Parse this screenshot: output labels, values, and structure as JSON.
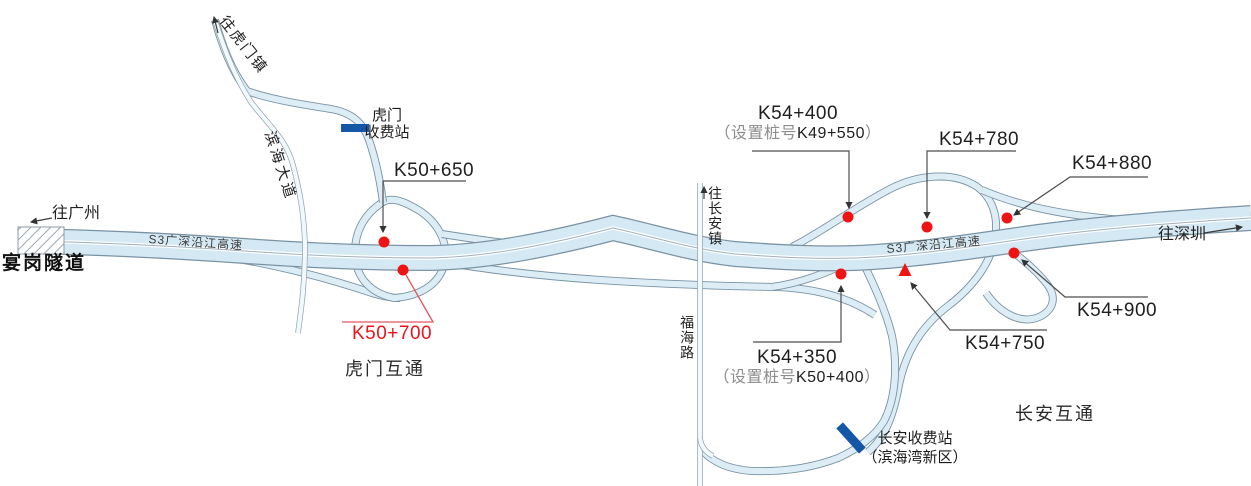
{
  "map": {
    "highway_label": "S3广深沿江高速",
    "directions": {
      "west": "往广州",
      "east": "往深圳",
      "humen_town": "往虎门镇",
      "changan_town": "往长安镇"
    },
    "tunnel": {
      "name": "宴岗隧道"
    },
    "roads": {
      "binhai_avenue": "滨海大道",
      "fuhai_road": "福海路"
    },
    "interchanges": {
      "humen": "虎门互通",
      "changan": "长安互通"
    },
    "toll_stations": {
      "humen": {
        "line1": "虎门",
        "line2": "收费站"
      },
      "changan": {
        "line1": "长安收费站",
        "line2": "（滨海湾新区）"
      }
    },
    "markers": {
      "k50_650": {
        "label": "K50+650"
      },
      "k50_700": {
        "label": "K50+700"
      },
      "k54_400": {
        "label": "K54+400",
        "note_prefix": "（设置桩号",
        "note_value": "K49+550",
        "note_suffix": "）"
      },
      "k54_350": {
        "label": "K54+350",
        "note_prefix": "（设置桩号",
        "note_value": "K50+400",
        "note_suffix": "）"
      },
      "k54_780": {
        "label": "K54+780"
      },
      "k54_880": {
        "label": "K54+880"
      },
      "k54_900": {
        "label": "K54+900"
      },
      "k54_750": {
        "label": "K54+750"
      }
    },
    "colors": {
      "road_fill": "#d5e9f4",
      "road_outline": "#7a93a3",
      "marker_red": "#ee1414",
      "toll_bar_blue": "#1457a7",
      "highlight_text_red": "#e8151e"
    }
  }
}
